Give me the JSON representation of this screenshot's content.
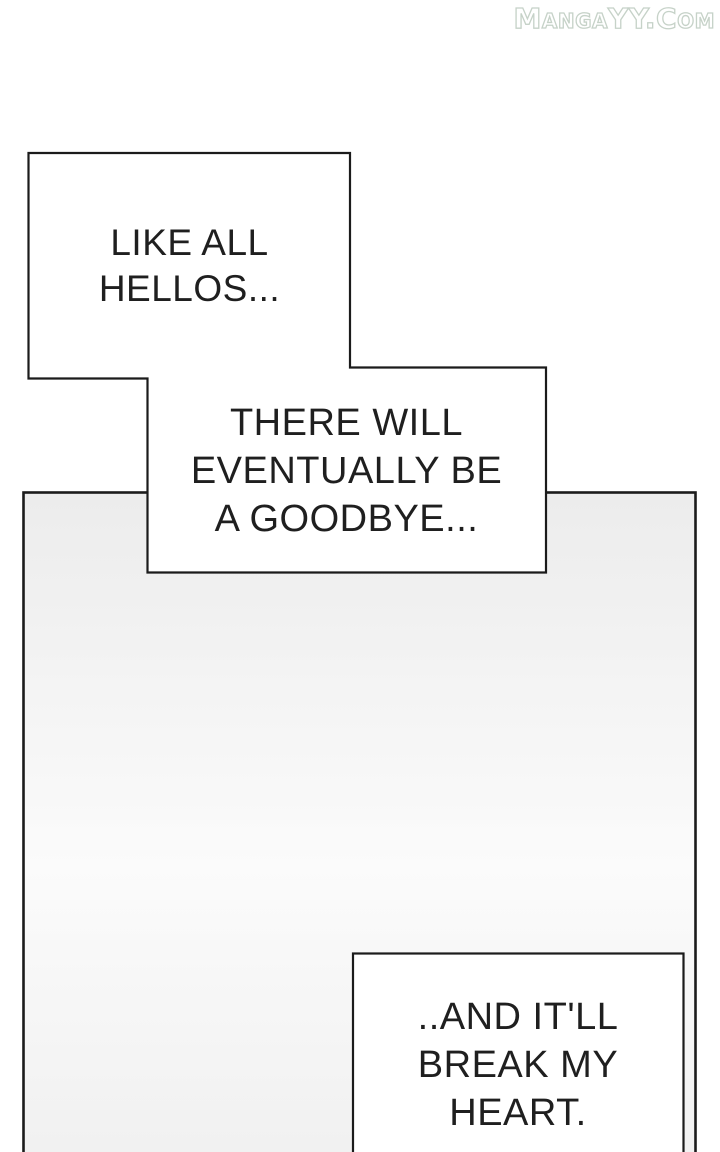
{
  "watermark": {
    "text": "MangaYY.Com"
  },
  "colors": {
    "page_bg": "#ffffff",
    "panel_top": "#ececec",
    "panel_mid": "#fbfbfb",
    "panel_bottom": "#f0f0f0",
    "line": "#1b1b1b",
    "text": "#1f1f1f",
    "bubble_fill": "#ffffff",
    "watermark": "#c6d2c8"
  },
  "bubbles": [
    {
      "name": "speech-box-1",
      "lines": [
        "LIKE ALL",
        "HELLOS..."
      ]
    },
    {
      "name": "speech-box-2",
      "lines": [
        "THERE WILL",
        "EVENTUALLY BE",
        "A GOODBYE..."
      ]
    },
    {
      "name": "speech-box-3",
      "lines": [
        "..AND IT'LL",
        "BREAK MY",
        "HEART."
      ]
    }
  ]
}
